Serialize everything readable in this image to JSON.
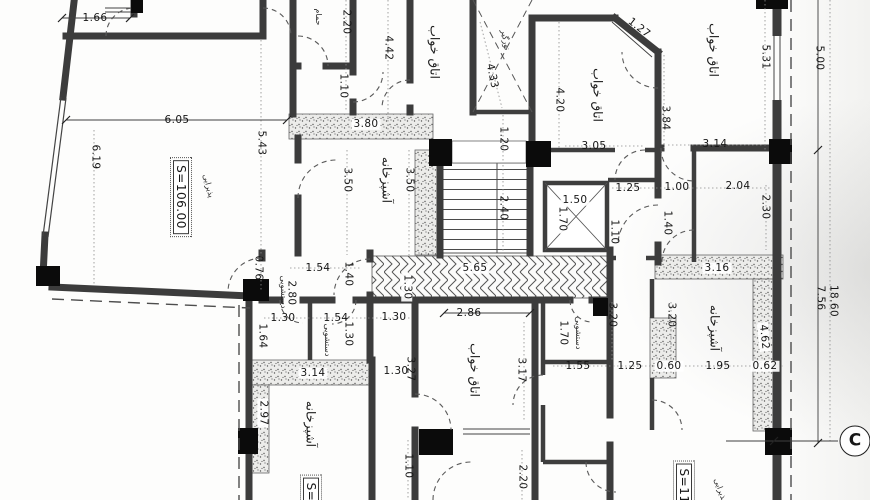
{
  "drawing": {
    "section_marker": "C",
    "area_living_left": "S=106.00",
    "area_living_right": "S=11",
    "room_names": [
      "اتاق خواب",
      "آشپزخانه",
      "پذیرایی",
      "دستشویی",
      "حمام",
      "نورگیر"
    ]
  },
  "labels": [
    {
      "t": "1.66",
      "x": 95,
      "y": 18
    },
    {
      "t": "حمام",
      "x": 318,
      "y": 17,
      "r": 90,
      "c": "tiny",
      "n": "room-label-bath"
    },
    {
      "t": "2.20",
      "x": 346,
      "y": 22,
      "r": 90
    },
    {
      "t": "4.42",
      "x": 388,
      "y": 48,
      "r": 90
    },
    {
      "t": "اتاق خواب",
      "x": 434,
      "y": 52,
      "r": 90,
      "c": "room",
      "n": "room-label-bedroom"
    },
    {
      "t": "نورگیر",
      "x": 505,
      "y": 40,
      "r": 80,
      "c": "tiny",
      "n": "room-label-lightwell"
    },
    {
      "t": "4.33",
      "x": 492,
      "y": 76,
      "r": 78
    },
    {
      "t": "1.27",
      "x": 639,
      "y": 28,
      "r": 38
    },
    {
      "t": "اتاق خواب",
      "x": 597,
      "y": 95,
      "r": 90,
      "c": "room",
      "n": "room-label-bedroom"
    },
    {
      "t": "اتاق خواب",
      "x": 713,
      "y": 50,
      "r": 90,
      "c": "room",
      "n": "room-label-bedroom"
    },
    {
      "t": "5.31",
      "x": 765,
      "y": 57,
      "r": 90
    },
    {
      "t": "5.00",
      "x": 819,
      "y": 58,
      "r": 90
    },
    {
      "t": "4.20",
      "x": 559,
      "y": 100,
      "r": 90
    },
    {
      "t": "3.84",
      "x": 665,
      "y": 118,
      "r": 90
    },
    {
      "t": "1.10",
      "x": 343,
      "y": 86,
      "r": 90
    },
    {
      "t": "3.80",
      "x": 366,
      "y": 124,
      "c": "dimh"
    },
    {
      "t": "1.20",
      "x": 503,
      "y": 139,
      "r": 90
    },
    {
      "t": "3.05",
      "x": 594,
      "y": 146
    },
    {
      "t": "3.14",
      "x": 715,
      "y": 144
    },
    {
      "t": "6.05",
      "x": 177,
      "y": 120
    },
    {
      "t": "5.43",
      "x": 261,
      "y": 143,
      "r": 90
    },
    {
      "t": "6.19",
      "x": 95,
      "y": 157,
      "r": 90
    },
    {
      "t": "S=106.00",
      "x": 181,
      "y": 197,
      "r": 90,
      "c": "area",
      "n": "area-label"
    },
    {
      "t": "پذیرایی",
      "x": 208,
      "y": 186,
      "r": 75,
      "c": "tiny",
      "n": "room-label-living"
    },
    {
      "t": "آشپزخانه",
      "x": 386,
      "y": 180,
      "r": 90,
      "c": "room",
      "n": "room-label-kitchen"
    },
    {
      "t": "3.50",
      "x": 347,
      "y": 180,
      "r": 90
    },
    {
      "t": "3.50",
      "x": 409,
      "y": 180,
      "r": 90
    },
    {
      "t": "2.40",
      "x": 503,
      "y": 208,
      "r": 90
    },
    {
      "t": "1.50",
      "x": 575,
      "y": 200,
      "c": "dimh"
    },
    {
      "t": "1.70",
      "x": 562,
      "y": 219,
      "r": 90,
      "c": "dimh"
    },
    {
      "t": "1.25",
      "x": 628,
      "y": 188
    },
    {
      "t": "1.00",
      "x": 677,
      "y": 187
    },
    {
      "t": "2.04",
      "x": 738,
      "y": 186
    },
    {
      "t": "2.30",
      "x": 765,
      "y": 207,
      "r": 90
    },
    {
      "t": "1.40",
      "x": 667,
      "y": 223,
      "r": 90
    },
    {
      "t": "1.10",
      "x": 614,
      "y": 232,
      "r": 90
    },
    {
      "t": "5.65",
      "x": 475,
      "y": 268,
      "c": "dimh"
    },
    {
      "t": "1.30",
      "x": 407,
      "y": 287,
      "r": 90,
      "c": "dimh"
    },
    {
      "t": "1.54",
      "x": 318,
      "y": 268
    },
    {
      "t": "1.40",
      "x": 348,
      "y": 274,
      "r": 90
    },
    {
      "t": "0.76",
      "x": 258,
      "y": 268,
      "r": 90
    },
    {
      "t": "2.80",
      "x": 291,
      "y": 293,
      "r": 90
    },
    {
      "t": "دستشویی",
      "x": 283,
      "y": 292,
      "r": 90,
      "c": "tiny",
      "n": "room-label-wc"
    },
    {
      "t": "1.30",
      "x": 283,
      "y": 318
    },
    {
      "t": "1.54",
      "x": 336,
      "y": 318
    },
    {
      "t": "1.30",
      "x": 394,
      "y": 317
    },
    {
      "t": "1.30",
      "x": 348,
      "y": 334,
      "r": 90
    },
    {
      "t": "1.64",
      "x": 262,
      "y": 336,
      "r": 90
    },
    {
      "t": "دستشویی",
      "x": 327,
      "y": 340,
      "r": 90,
      "c": "tiny",
      "n": "room-label-wc"
    },
    {
      "t": "3.14",
      "x": 313,
      "y": 373,
      "c": "dimh"
    },
    {
      "t": "2.97",
      "x": 263,
      "y": 413,
      "r": 90,
      "c": "dimh"
    },
    {
      "t": "آشپزخانه",
      "x": 310,
      "y": 424,
      "r": 90,
      "c": "room",
      "n": "room-label-kitchen"
    },
    {
      "t": "1.30",
      "x": 396,
      "y": 371
    },
    {
      "t": "3.27",
      "x": 410,
      "y": 369,
      "r": 90
    },
    {
      "t": "2.86",
      "x": 469,
      "y": 313
    },
    {
      "t": "اتاق خواب",
      "x": 474,
      "y": 370,
      "r": 90,
      "c": "room",
      "n": "room-label-bedroom"
    },
    {
      "t": "3.17",
      "x": 521,
      "y": 370,
      "r": 90
    },
    {
      "t": "1.70",
      "x": 563,
      "y": 333,
      "r": 90
    },
    {
      "t": "دستشویی",
      "x": 578,
      "y": 333,
      "r": 90,
      "c": "tiny",
      "n": "room-label-wc"
    },
    {
      "t": "1.55",
      "x": 578,
      "y": 366
    },
    {
      "t": "3.20",
      "x": 612,
      "y": 315,
      "r": 90
    },
    {
      "t": "3.20",
      "x": 671,
      "y": 315,
      "r": 90
    },
    {
      "t": "3.16",
      "x": 717,
      "y": 268,
      "c": "dimh"
    },
    {
      "t": "آشپزخانه",
      "x": 714,
      "y": 328,
      "r": 90,
      "c": "room",
      "n": "room-label-kitchen"
    },
    {
      "t": "1.25",
      "x": 630,
      "y": 366
    },
    {
      "t": "0.60",
      "x": 669,
      "y": 366,
      "c": "dimh"
    },
    {
      "t": "1.95",
      "x": 718,
      "y": 366
    },
    {
      "t": "0.62",
      "x": 765,
      "y": 366,
      "c": "dimh"
    },
    {
      "t": "4.62",
      "x": 764,
      "y": 337,
      "r": 84,
      "c": "dimh"
    },
    {
      "t": "7.56",
      "x": 820,
      "y": 298,
      "r": 90
    },
    {
      "t": "18.60",
      "x": 833,
      "y": 301,
      "r": 90
    },
    {
      "t": "1.10",
      "x": 408,
      "y": 466,
      "r": 90
    },
    {
      "t": "2.20",
      "x": 522,
      "y": 477,
      "r": 90
    },
    {
      "t": "S=11",
      "x": 684,
      "y": 486,
      "r": 90,
      "c": "area",
      "n": "area-label"
    },
    {
      "t": "پذیرایی",
      "x": 720,
      "y": 490,
      "r": 70,
      "c": "tiny",
      "n": "room-label-living"
    },
    {
      "t": "S=1",
      "x": 311,
      "y": 496,
      "r": 90,
      "c": "area",
      "n": "area-label"
    },
    {
      "t": "C",
      "x": 855,
      "y": 441,
      "c": "marker",
      "n": "section-marker-c"
    }
  ]
}
